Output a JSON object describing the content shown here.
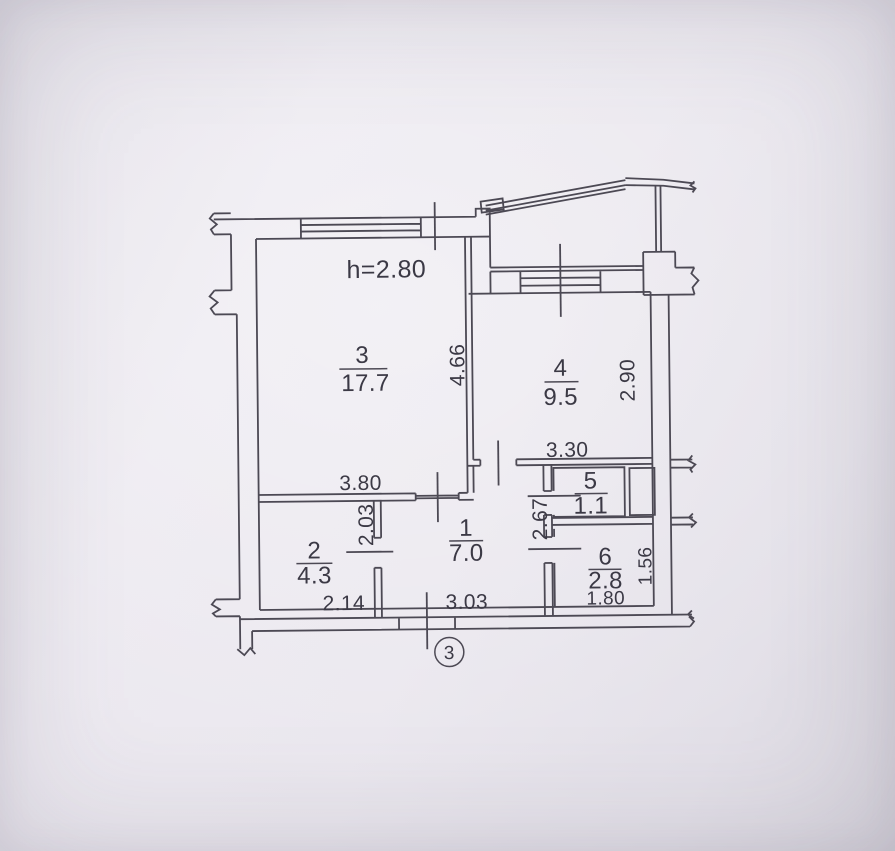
{
  "labels": {
    "ceiling_height": "h=2.80",
    "section_axis": "3"
  },
  "rooms": {
    "r1": {
      "number": "1",
      "area": "7.0"
    },
    "r2": {
      "number": "2",
      "area": "4.3"
    },
    "r3": {
      "number": "3",
      "area": "17.7"
    },
    "r4": {
      "number": "4",
      "area": "9.5"
    },
    "r5": {
      "number": "5",
      "area": "1.1"
    },
    "r6": {
      "number": "6",
      "area": "2.8"
    }
  },
  "dimensions": {
    "room3_width": "3.80",
    "room3_depth": "4.66",
    "room4_width": "3.30",
    "room4_depth": "2.90",
    "room2_width": "2.14",
    "room2_depth": "2.03",
    "hall_width": "3.03",
    "hall_depth": "2.67",
    "room6_width": "1.80",
    "room6_depth": "1.56"
  },
  "colors": {
    "paper": "#e8e5ec",
    "ink": "#4c4954",
    "text": "#3b3945"
  }
}
